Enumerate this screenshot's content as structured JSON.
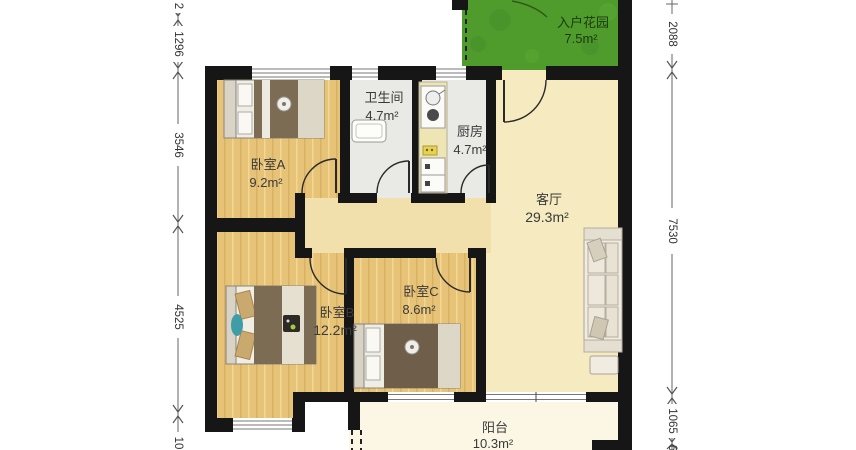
{
  "plan": {
    "title": "apartment-floor-plan",
    "rooms": [
      {
        "name": "入户花园",
        "area": "7.5m²"
      },
      {
        "name": "卧室A",
        "area": "9.2m²"
      },
      {
        "name": "卫生间",
        "area": "4.7m²"
      },
      {
        "name": "厨房",
        "area": "4.7m²"
      },
      {
        "name": "客厅",
        "area": "29.3m²"
      },
      {
        "name": "卧室B",
        "area": "12.2m²"
      },
      {
        "name": "卧室C",
        "area": "8.6m²"
      },
      {
        "name": "阳台",
        "area": "10.3m²"
      }
    ],
    "dimensions": {
      "left": [
        "2",
        "1296",
        "3546",
        "4525",
        "10"
      ],
      "right": [
        "2088",
        "7530",
        "1065",
        "6"
      ]
    },
    "colors": {
      "wall": "#161616",
      "wood_floor": "#E7C377",
      "living_floor": "#F6EAC0",
      "hall_floor": "#F2E0AC",
      "balcony_floor": "#FBF7E4",
      "garden": "#4F9C2D",
      "wet_room": "#E9E9E6"
    }
  }
}
